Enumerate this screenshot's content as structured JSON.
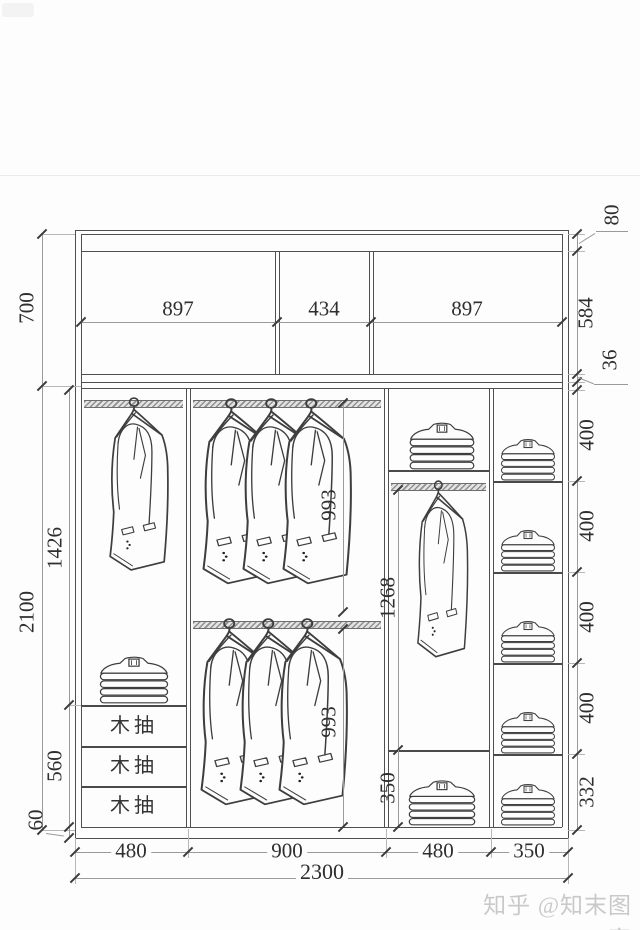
{
  "drawing": {
    "top_section": {
      "height": "700",
      "compartments": [
        "897",
        "434",
        "897"
      ],
      "right": {
        "top": "80",
        "middle": "584",
        "bottom": "36"
      }
    },
    "left": {
      "total": "2100",
      "hanging": "1426",
      "drawer_unit": "560",
      "base": "60"
    },
    "middle": {
      "top_hang": "993",
      "bottom_hang": "993",
      "right_hang": "1268",
      "right_bottom": "350"
    },
    "right_shelves": [
      "400",
      "400",
      "400",
      "400",
      "332"
    ],
    "drawers": [
      "木抽",
      "木抽",
      "木抽"
    ],
    "bottom": {
      "widths": [
        "480",
        "900",
        "480",
        "350"
      ],
      "total": "2300"
    }
  },
  "watermark": "知乎 @知末图窗"
}
